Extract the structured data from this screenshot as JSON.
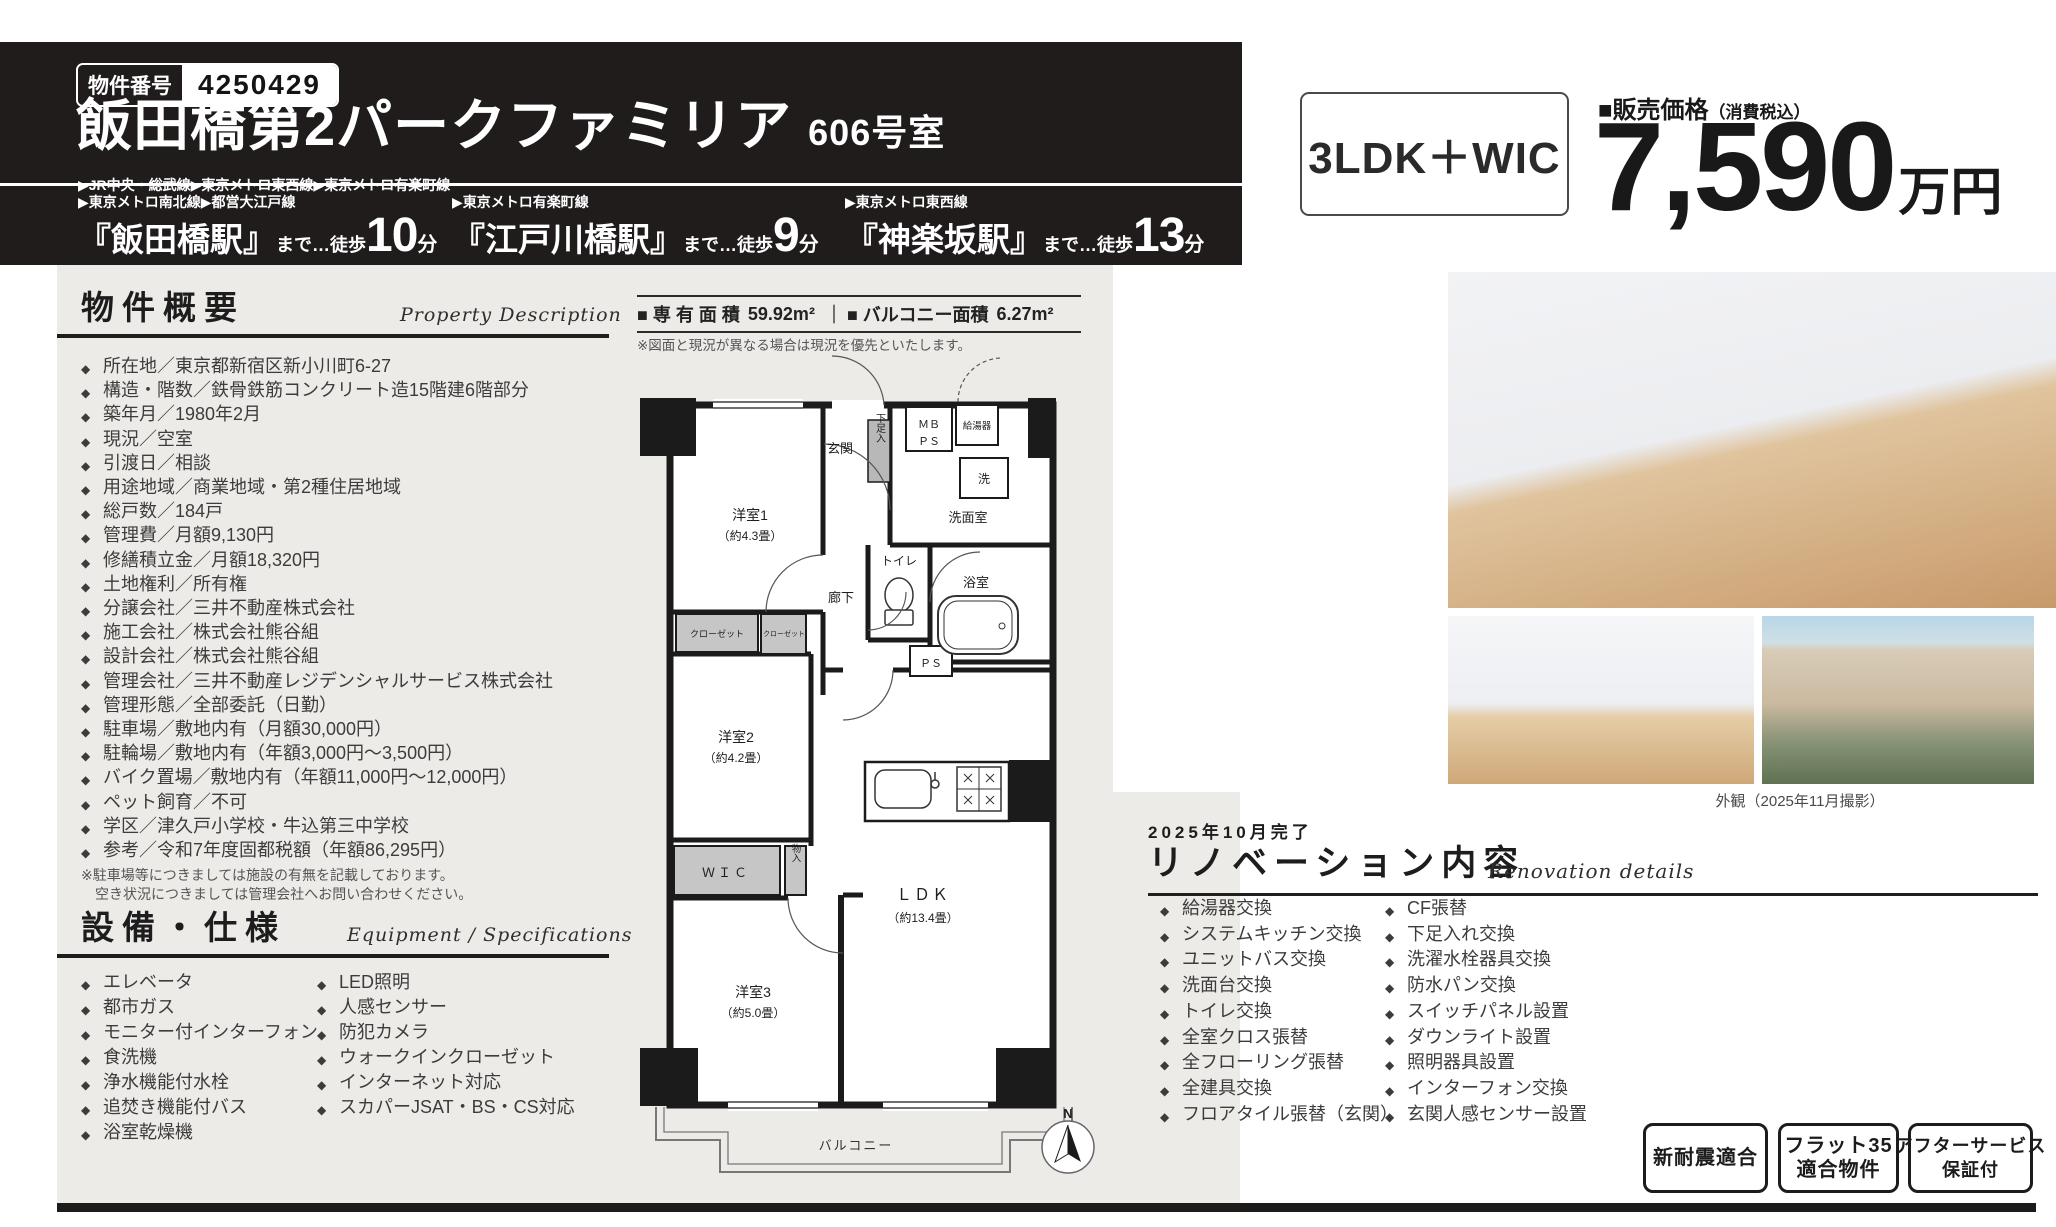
{
  "header": {
    "property_number_label": "物件番号",
    "property_number": "4250429",
    "building_title": "飯田橋第2パークファミリア",
    "room_number": "606号室"
  },
  "price": {
    "layout": "3LDK＋WIC",
    "label": "■販売価格",
    "tax_note": "（消費税込）",
    "amount": "7,590",
    "unit": "万円"
  },
  "stations": [
    {
      "line1": "▶JR中央・総武線▶東京メトロ東西線▶東京メトロ有楽町線",
      "line2": "▶東京メトロ南北線▶都営大江戸線",
      "name": "『飯田橋駅』",
      "walk": "まで…徒歩",
      "minutes": "10",
      "minutes_unit": "分"
    },
    {
      "line1": "▶東京メトロ有楽町線",
      "name": "『江戸川橋駅』",
      "walk": "まで…徒歩",
      "minutes": "9",
      "minutes_unit": "分"
    },
    {
      "line1": "▶東京メトロ東西線",
      "name": "『神楽坂駅』",
      "walk": "まで…徒歩",
      "minutes": "13",
      "minutes_unit": "分"
    }
  ],
  "area_bar": {
    "exclusive_label": "■ 専 有 面 積",
    "exclusive_value": "59.92m²",
    "divider": "｜",
    "balcony_label": "■ バルコニー面積",
    "balcony_value": "6.27m²",
    "note": "※図面と現況が異なる場合は現況を優先といたします。"
  },
  "overview": {
    "title": "物件概要",
    "subtitle": "Property Description",
    "items": [
      "所在地／東京都新宿区新小川町6-27",
      "構造・階数／鉄骨鉄筋コンクリート造15階建6階部分",
      "築年月／1980年2月",
      "現況／空室",
      "引渡日／相談",
      "用途地域／商業地域・第2種住居地域",
      "総戸数／184戸",
      "管理費／月額9,130円",
      "修繕積立金／月額18,320円",
      "土地権利／所有権",
      "分譲会社／三井不動産株式会社",
      "施工会社／株式会社熊谷組",
      "設計会社／株式会社熊谷組",
      "管理会社／三井不動産レジデンシャルサービス株式会社",
      "管理形態／全部委託（日勤）",
      "駐車場／敷地内有（月額30,000円）",
      "駐輪場／敷地内有（年額3,000円～3,500円）",
      "バイク置場／敷地内有（年額11,000円～12,000円）",
      "ペット飼育／不可",
      "学区／津久戸小学校・牛込第三中学校",
      "参考／令和7年度固都税額（年額86,295円）"
    ],
    "note_line1": "※駐車場等につきましては施設の有無を記載しております。",
    "note_line2": "空き状況につきましては管理会社へお問い合わせください。"
  },
  "equipment": {
    "title": "設備・仕様",
    "subtitle": "Equipment / Specifications",
    "col1": [
      "エレベータ",
      "都市ガス",
      "モニター付インターフォン",
      "食洗機",
      "浄水機能付水栓",
      "追焚き機能付バス",
      "浴室乾燥機"
    ],
    "col2": [
      "LED照明",
      "人感センサー",
      "防犯カメラ",
      "ウォークインクローゼット",
      "インターネット対応",
      "スカパーJSAT・BS・CS対応"
    ]
  },
  "renovation": {
    "completed": "2025年10月完了",
    "title": "リノベーション内容",
    "subtitle": "Renovation details",
    "col1": [
      "給湯器交換",
      "システムキッチン交換",
      "ユニットバス交換",
      "洗面台交換",
      "トイレ交換",
      "全室クロス張替",
      "全フローリング張替",
      "全建具交換",
      "フロアタイル張替（玄関）"
    ],
    "col2": [
      "CF張替",
      "下足入れ交換",
      "洗濯水栓器具交換",
      "防水パン交換",
      "スイッチパネル設置",
      "ダウンライト設置",
      "照明器具設置",
      "インターフォン交換",
      "玄関人感センサー設置"
    ]
  },
  "photos": {
    "exterior_caption": "外観（2025年11月撮影）"
  },
  "badges": [
    {
      "line1": "新耐震適合",
      "line2": ""
    },
    {
      "line1": "フラット35",
      "line2": "適合物件"
    },
    {
      "line1": "アフターサービス",
      "line2": "保証付"
    }
  ],
  "floorplan": {
    "room1_name": "洋室1",
    "room1_size": "（約4.3畳）",
    "room2_name": "洋室2",
    "room2_size": "（約4.2畳）",
    "room3_name": "洋室3",
    "room3_size": "（約5.0畳）",
    "ldk_name": "ＬＤＫ",
    "ldk_size": "（約13.4畳）",
    "genkan": "玄関",
    "shoe_box": "下足入",
    "mb": "ＭＢ",
    "ps_top": "ＰＳ",
    "water_heater": "給湯器",
    "washer": "洗",
    "washroom": "洗面室",
    "toilet": "トイレ",
    "bath": "浴室",
    "hallway": "廊下",
    "ps": "ＰＳ",
    "closet1": "クローゼット",
    "closet2": "クローゼット",
    "wic": "ＷＩＣ",
    "storage": "物入",
    "balcony": "バルコニー",
    "north": "N"
  }
}
